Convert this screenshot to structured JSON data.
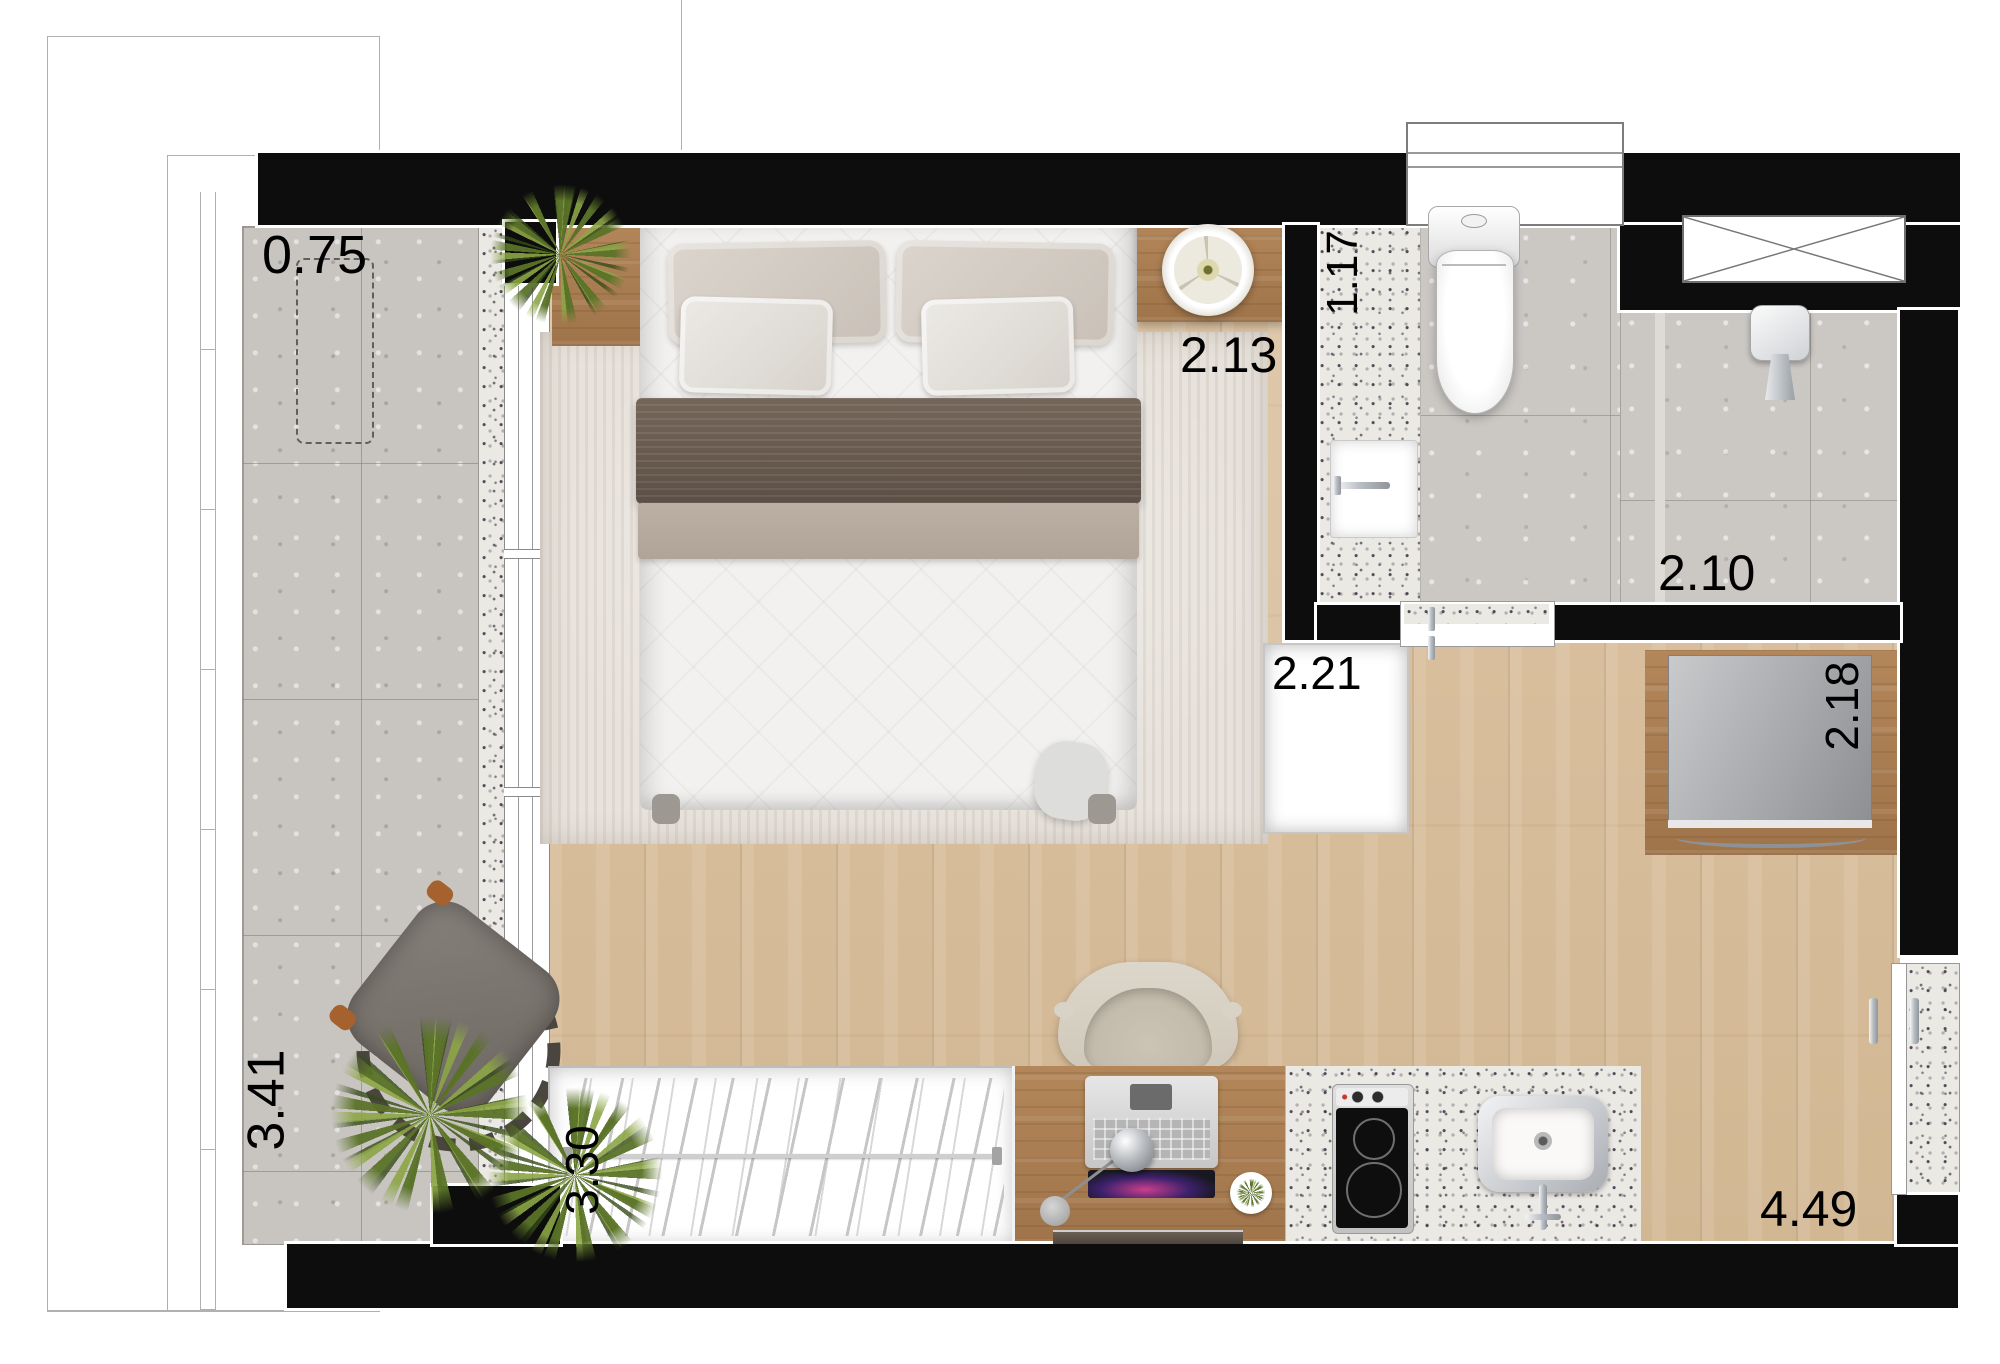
{
  "dimensions": {
    "balcony_depth": "0.75",
    "balcony_length": "3.41",
    "bed_width": "2.13",
    "bath_width": "1.17",
    "bath_length": "2.10",
    "niche_width": "2.21",
    "tv_width": "2.18",
    "closet_length": "3.30",
    "kitchen_length": "4.49"
  },
  "colors": {
    "wall": "#0d0d0d",
    "wood_floor": "#d7bd9b",
    "furniture_wood": "#ac7f50",
    "balcony_concrete": "#c8c5c1",
    "bath_tiles": "#cbc8c4",
    "stone_granite": "#ebe9e4",
    "rug": "#e7e2db",
    "plant_green": "#7d9440",
    "tv_screen": "#a9abae",
    "bed_linen": "#f2f1ef",
    "throw_brown": "#68594d"
  }
}
